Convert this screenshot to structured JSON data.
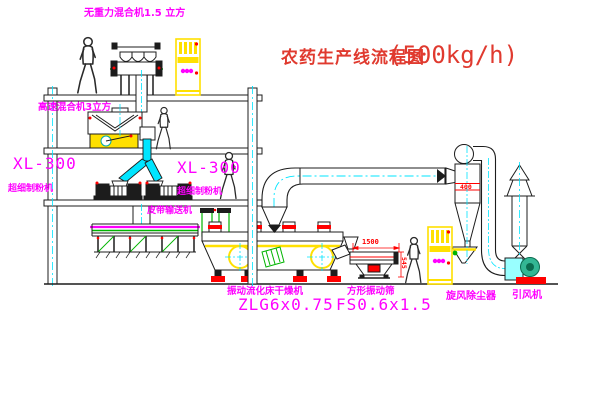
{
  "title": {
    "name": "农药生产线流程图",
    "capacity": "(500kg/h)"
  },
  "labels": {
    "gravity_mixer": "无重力混合机1.5 立方",
    "high_speed_mixer": "高速混合机3立方",
    "mill_left_model": "XL-300",
    "mill_left_name": "超细制粉机",
    "mill_center_model": "XL-300",
    "mill_center_name": "超细制粉机",
    "belt_conveyor": "皮带输送机",
    "dryer_name": "振动流化床干燥机",
    "dryer_model": "ZLG6x0.75",
    "screen_name": "方形振动筛",
    "screen_model": "FS0.6x1.5",
    "cyclone": "旋风除尘器",
    "fan": "引风机"
  },
  "dimensions": {
    "screen_length": "1500",
    "screen_height": "545",
    "cyclone_size": "400"
  },
  "colors": {
    "label_magenta": "#ff00ff",
    "title_red": "#e03a2f",
    "line_black": "#1c1c1c",
    "pipe_cyan": "#00e5ff",
    "machine_yellow": "#ffe000",
    "accent_red": "#ff0000",
    "pipe_green": "#00b400"
  }
}
